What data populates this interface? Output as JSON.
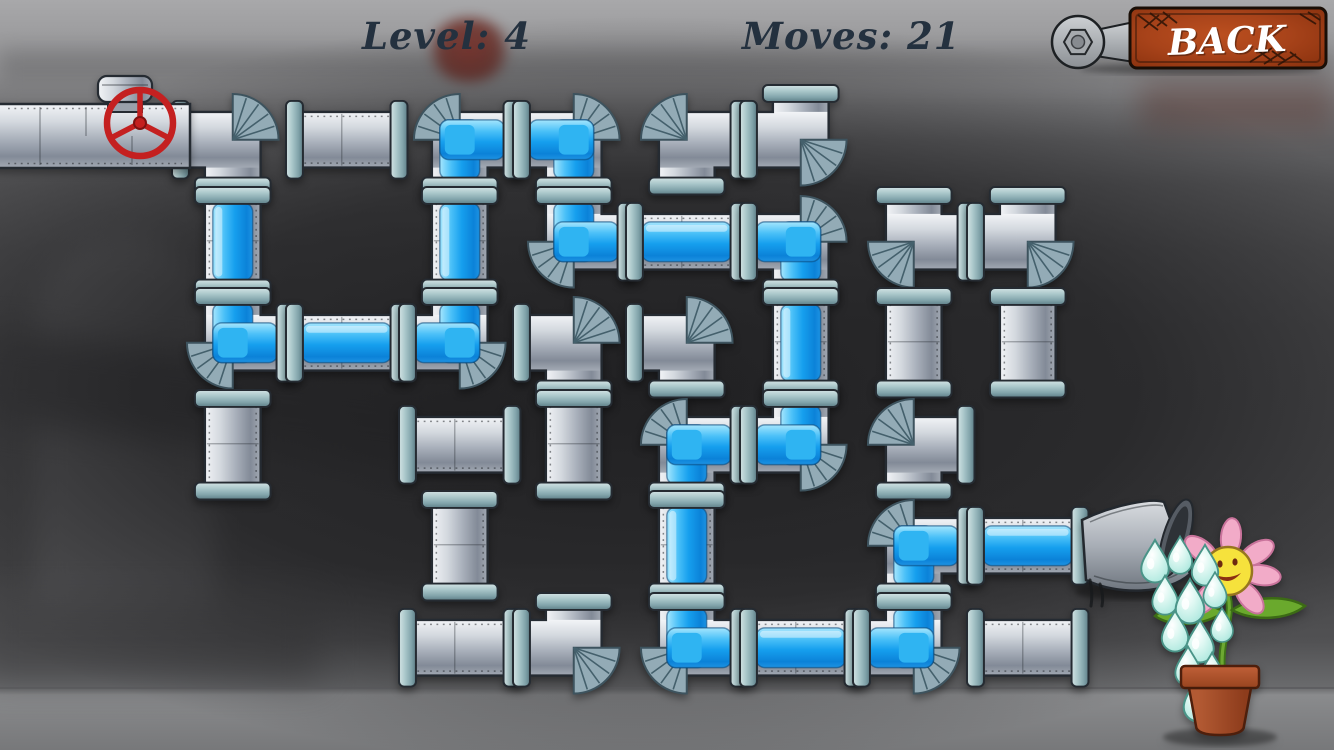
{
  "hud": {
    "level": "Level: 4",
    "moves": "Moves: 21",
    "back": "BACK"
  },
  "colors": {
    "hud_text": "#24313f",
    "back_button_rust": "#a8431a",
    "back_text": "#ffffff",
    "valve_red": "#c42020",
    "water_blue": "#169fee",
    "pipe_metal": "#aab1bb",
    "coupling_teal": "#94b4ba",
    "fan_steel": "#93abb6",
    "drop_aqua": "#bdebe2",
    "flower_petal_pink": "#f2abc8",
    "flower_face_yellow": "#f6e23c",
    "leaf_green": "#6aa92d",
    "pot_terracotta": "#ad5030",
    "background_dark": "#454547"
  },
  "board": {
    "cols": 8,
    "rows": 6,
    "cell_w": 113.5,
    "cell_h": 101.5,
    "origin_x": 176,
    "origin_y": 89,
    "pieces": [
      {
        "col": 1,
        "row": 1,
        "ports": [
          "left",
          "down"
        ],
        "filled": false
      },
      {
        "col": 2,
        "row": 1,
        "ports": [
          "left",
          "right"
        ],
        "filled": false
      },
      {
        "col": 3,
        "row": 1,
        "ports": [
          "right",
          "down"
        ],
        "filled": true
      },
      {
        "col": 4,
        "row": 1,
        "ports": [
          "left",
          "down"
        ],
        "filled": true
      },
      {
        "col": 5,
        "row": 1,
        "ports": [
          "right",
          "down"
        ],
        "filled": false
      },
      {
        "col": 6,
        "row": 1,
        "ports": [
          "up",
          "left"
        ],
        "filled": false
      },
      {
        "col": 1,
        "row": 2,
        "ports": [
          "up",
          "down"
        ],
        "filled": true
      },
      {
        "col": 3,
        "row": 2,
        "ports": [
          "up",
          "down"
        ],
        "filled": true
      },
      {
        "col": 4,
        "row": 2,
        "ports": [
          "up",
          "right"
        ],
        "filled": true
      },
      {
        "col": 5,
        "row": 2,
        "ports": [
          "left",
          "right"
        ],
        "filled": true
      },
      {
        "col": 6,
        "row": 2,
        "ports": [
          "left",
          "down"
        ],
        "filled": true
      },
      {
        "col": 7,
        "row": 2,
        "ports": [
          "up",
          "right"
        ],
        "filled": false
      },
      {
        "col": 8,
        "row": 2,
        "ports": [
          "up",
          "left"
        ],
        "filled": false
      },
      {
        "col": 1,
        "row": 3,
        "ports": [
          "up",
          "right"
        ],
        "filled": true
      },
      {
        "col": 2,
        "row": 3,
        "ports": [
          "left",
          "right"
        ],
        "filled": true
      },
      {
        "col": 3,
        "row": 3,
        "ports": [
          "up",
          "left"
        ],
        "filled": true
      },
      {
        "col": 4,
        "row": 3,
        "ports": [
          "left",
          "down"
        ],
        "filled": false
      },
      {
        "col": 5,
        "row": 3,
        "ports": [
          "left",
          "down"
        ],
        "filled": false
      },
      {
        "col": 6,
        "row": 3,
        "ports": [
          "up",
          "down"
        ],
        "filled": true
      },
      {
        "col": 7,
        "row": 3,
        "ports": [
          "up",
          "down"
        ],
        "filled": false
      },
      {
        "col": 8,
        "row": 3,
        "ports": [
          "up",
          "down"
        ],
        "filled": false
      },
      {
        "col": 1,
        "row": 4,
        "ports": [
          "up",
          "down"
        ],
        "filled": false
      },
      {
        "col": 3,
        "row": 4,
        "ports": [
          "left",
          "right"
        ],
        "filled": false
      },
      {
        "col": 4,
        "row": 4,
        "ports": [
          "up",
          "down"
        ],
        "filled": false
      },
      {
        "col": 5,
        "row": 4,
        "ports": [
          "right",
          "down"
        ],
        "filled": true
      },
      {
        "col": 6,
        "row": 4,
        "ports": [
          "up",
          "left"
        ],
        "filled": true
      },
      {
        "col": 7,
        "row": 4,
        "ports": [
          "right",
          "down"
        ],
        "filled": false
      },
      {
        "col": 3,
        "row": 5,
        "ports": [
          "up",
          "down"
        ],
        "filled": false
      },
      {
        "col": 5,
        "row": 5,
        "ports": [
          "up",
          "down"
        ],
        "filled": true
      },
      {
        "col": 7,
        "row": 5,
        "ports": [
          "down",
          "right"
        ],
        "filled": true
      },
      {
        "col": 8,
        "row": 5,
        "ports": [
          "left",
          "right"
        ],
        "filled": true
      },
      {
        "col": 3,
        "row": 6,
        "ports": [
          "left",
          "right"
        ],
        "filled": false
      },
      {
        "col": 4,
        "row": 6,
        "ports": [
          "up",
          "left"
        ],
        "filled": false
      },
      {
        "col": 5,
        "row": 6,
        "ports": [
          "up",
          "right"
        ],
        "filled": true
      },
      {
        "col": 6,
        "row": 6,
        "ports": [
          "left",
          "right"
        ],
        "filled": true
      },
      {
        "col": 7,
        "row": 6,
        "ports": [
          "up",
          "left"
        ],
        "filled": true
      },
      {
        "col": 8,
        "row": 6,
        "ports": [
          "left",
          "right"
        ],
        "filled": false
      }
    ]
  },
  "source": {
    "type": "water-valve",
    "row": 1,
    "side": "left"
  },
  "goal": {
    "type": "flower-pot",
    "row": 5,
    "side": "right",
    "watering": true
  }
}
